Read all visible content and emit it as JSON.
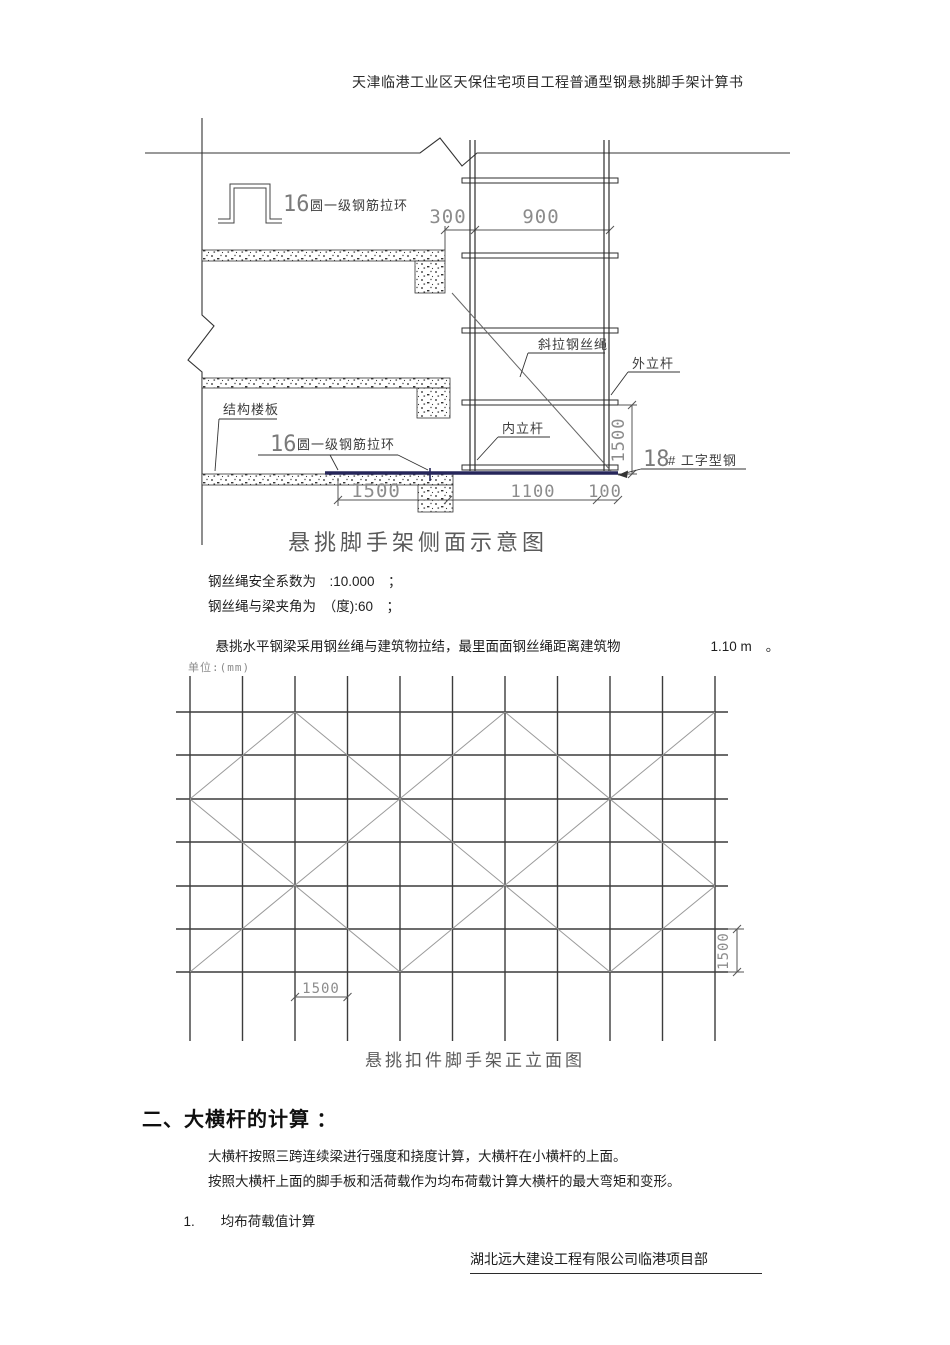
{
  "header": {
    "title": "天津临港工业区天保住宅项目工程普通型钢悬挑脚手架计算书"
  },
  "side_view": {
    "caption": "悬挑脚手架侧面示意图",
    "label_rebar_num_top": "16",
    "label_rebar_top": "圆一级钢筋拉环",
    "label_rebar_num_bottom": "16",
    "label_rebar_bottom": "圆一级钢筋拉环",
    "label_rope": "斜拉钢丝绳",
    "label_outer_pole": "外立杆",
    "label_inner_pole": "内立杆",
    "label_slab": "结构楼板",
    "label_ibeam_num": "18",
    "label_ibeam": "# 工字型钢",
    "dim_300": "300",
    "dim_900": "900",
    "dim_1500_vertical": "1500",
    "dim_1500_bottom": "1500",
    "dim_1100": "1100",
    "dim_100": "100",
    "beam_color": "#26265a"
  },
  "notes": {
    "line1": "钢丝绳安全系数为　:10.000　；",
    "line2": "钢丝绳与梁夹角为　（度):60　；",
    "line3": "悬挑水平钢梁采用钢丝绳与建筑物拉结，最里面面钢丝绳距离建筑物",
    "line3_value": "1.10 m",
    "line3_end": "。"
  },
  "elevation": {
    "unit_label": "单位:(mm)",
    "caption": "悬挑扣件脚手架正立面图",
    "dim_bottom": "1500",
    "dim_right": "1500"
  },
  "section2": {
    "heading": "二、大横杆的计算 ：",
    "para1": "大横杆按照三跨连续梁进行强度和挠度计算，大横杆在小横杆的上面。",
    "para2": "按照大横杆上面的脚手板和活荷载作为均布荷载计算大横杆的最大弯矩和变形。",
    "item1_num": "1.",
    "item1_text": "均布荷载值计算"
  },
  "footer": {
    "company": "湖北远大建设工程有限公司临港项目部"
  }
}
